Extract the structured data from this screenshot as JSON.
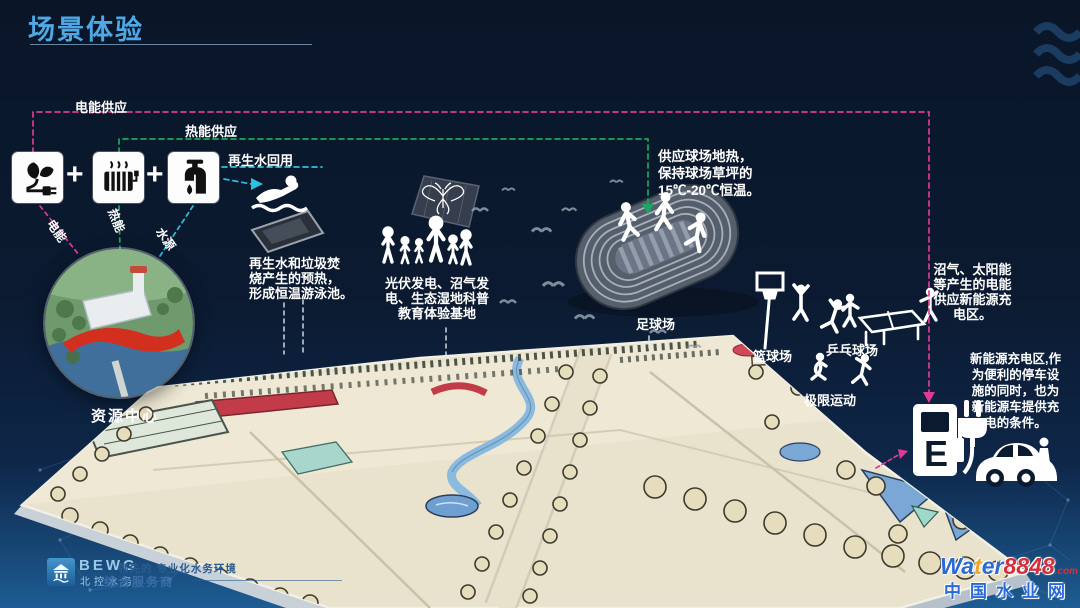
{
  "title": {
    "text": "场景体验"
  },
  "legend": {
    "electric_supply": "电能供应",
    "heat_supply": "热能供应",
    "water_reuse": "再生水回用",
    "electric": "电能",
    "heat": "热能",
    "water": "水源",
    "plus": "+"
  },
  "resource_center": {
    "label": "资源中心"
  },
  "annotations": {
    "pool": [
      "再生水和垃圾焚",
      "烧产生的预热，",
      "形成恒温游泳池。"
    ],
    "wetland": [
      "光伏发电、沼气发",
      "电、生态湿地科普",
      "教育体验基地"
    ],
    "field_heat": [
      "供应球场地热，",
      "保持球场草坪的",
      "15℃-20℃恒温。"
    ],
    "biogas": [
      "沼气、太阳能",
      "等产生的电能",
      "供应新能源充",
      "电区。"
    ],
    "charging": [
      "新能源充电区,作",
      "为便利的停车设",
      "施的同时，也为",
      "新能源车提供充",
      "电的条件。"
    ]
  },
  "venues": {
    "football": "足球场",
    "basketball": "篮球场",
    "pingpong": "乒乓球场",
    "extreme": "极限运动"
  },
  "charging_station": {
    "e_label": "E"
  },
  "footer": {
    "brand": "BEWG",
    "brand_cn": "北控水务",
    "slogan_line1": "领先的 专业化水务环境",
    "slogan_line2": "综合服务商"
  },
  "watermark": {
    "w1": "Wa",
    "w2": "t",
    "w3": "er",
    "num": "8848",
    "dotcom": ".com",
    "line2": "中国水业网"
  },
  "colors": {
    "electric_flow": "#e03a92",
    "heat_flow": "#1aa85e",
    "water_flow": "#2fc0dd",
    "accent": "#4fa8e6"
  }
}
